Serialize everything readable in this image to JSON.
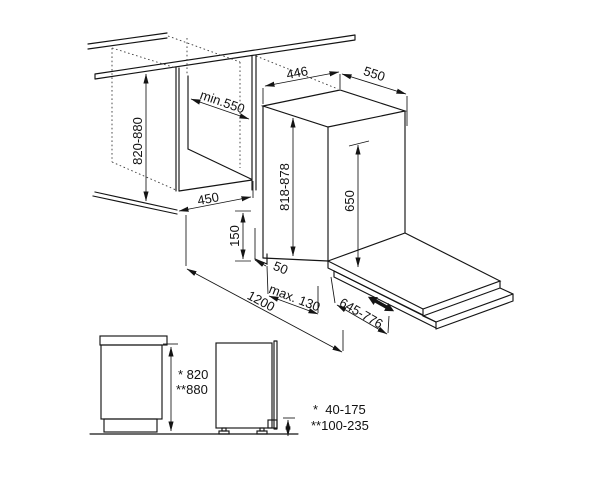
{
  "colors": {
    "line": "#141414",
    "background": "#ffffff"
  },
  "main_view": {
    "dims": {
      "niche_height": "820-880",
      "niche_depth": "min.550",
      "niche_width": "450",
      "appliance_width": "446",
      "appliance_depth": "550",
      "appliance_height": "818-878",
      "tub_height": "650",
      "plinth_height": "150",
      "front_offset": "50",
      "toe_kick_depth": "max. 130",
      "service_clearance": "1200",
      "door_open_reach": "645-776"
    }
  },
  "side_view": {
    "cabinet_height_line1": "* 820",
    "cabinet_height_line2": "**880"
  },
  "legend": {
    "adjust_line1": "*  40-175",
    "adjust_line2": "**100-235"
  }
}
